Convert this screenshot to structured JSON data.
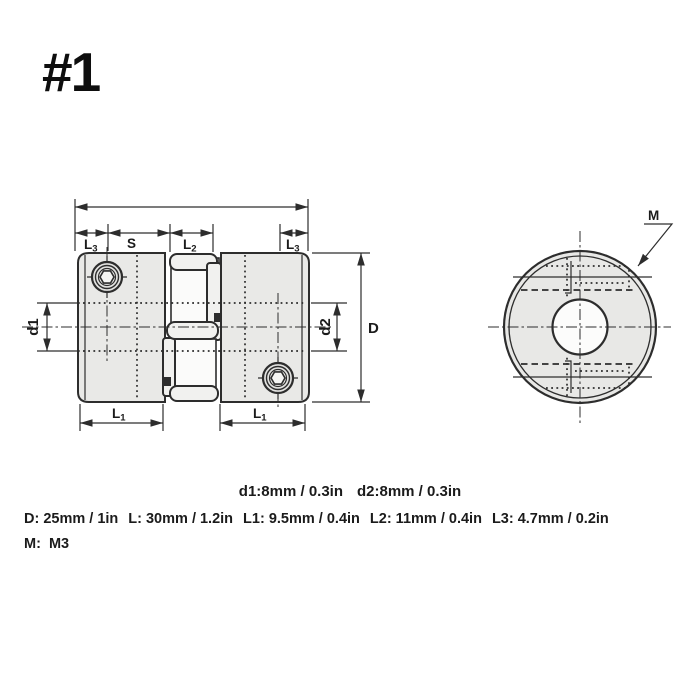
{
  "header": {
    "item_number": "#1"
  },
  "side_view": {
    "dim_labels": {
      "L3_left": {
        "base": "L",
        "sub": "3"
      },
      "S": {
        "base": "S"
      },
      "L2": {
        "base": "L",
        "sub": "2"
      },
      "L3_right": {
        "base": "L",
        "sub": "3"
      },
      "L1_left": {
        "base": "L",
        "sub": "1"
      },
      "L1_right": {
        "base": "L",
        "sub": "1"
      },
      "d1": "d1",
      "d2": "d2",
      "D": "D"
    }
  },
  "end_view": {
    "thread_label": "M"
  },
  "specs": {
    "bore_line": [
      "d1:8mm / 0.3in",
      "d2:8mm / 0.3in"
    ],
    "dimension_line": [
      "D: 25mm / 1in",
      "L: 30mm / 1.2in",
      "L1: 9.5mm / 0.4in",
      "L2: 11mm / 0.4in",
      "L3: 4.7mm / 0.2in"
    ],
    "thread_line": "M:  M3"
  },
  "colors": {
    "line": "#2d2d2d",
    "body_fill": "#e9e9e7",
    "text": "#1b1b1b",
    "background": "#ffffff"
  }
}
